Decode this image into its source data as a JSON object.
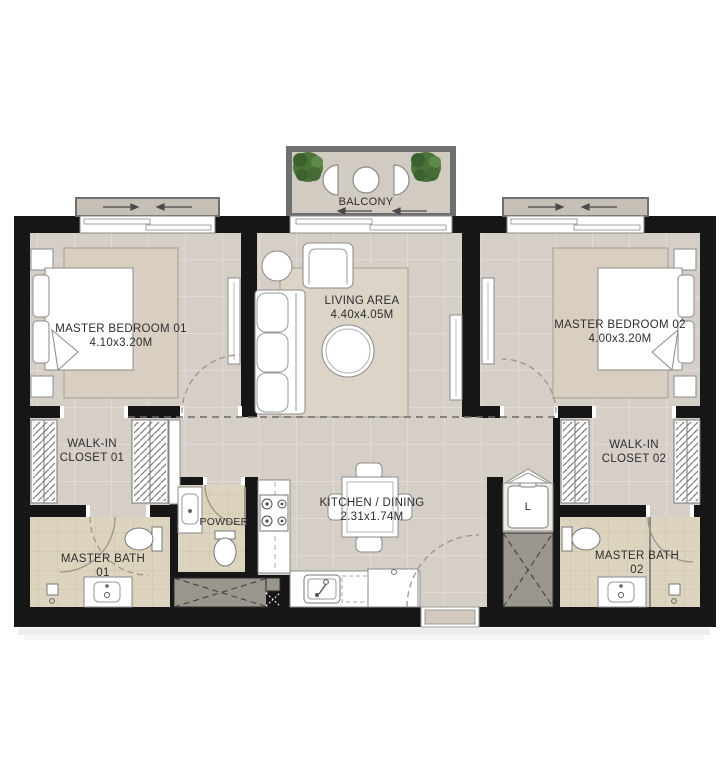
{
  "rooms": {
    "balcony": {
      "name": "BALCONY"
    },
    "master_bedroom_01": {
      "name": "MASTER BEDROOM 01",
      "dimensions": "4.10x3.20M"
    },
    "living_area": {
      "name": "LIVING AREA",
      "dimensions": "4.40x4.05M"
    },
    "master_bedroom_02": {
      "name": "MASTER BEDROOM 02",
      "dimensions": "4.00x3.20M"
    },
    "walk_in_closet_01": {
      "line1": "WALK-IN",
      "line2": "CLOSET 01"
    },
    "walk_in_closet_02": {
      "line1": "WALK-IN",
      "line2": "CLOSET 02"
    },
    "kitchen_dining": {
      "name": "KITCHEN / DINING",
      "dimensions": "2.31x1.74M"
    },
    "powder": {
      "name": "POWDER"
    },
    "master_bath_01": {
      "line1": "MASTER BATH",
      "line2": "01"
    },
    "master_bath_02": {
      "line1": "MASTER BATH",
      "line2": "02"
    },
    "laundry": {
      "name": "L"
    }
  },
  "colors": {
    "wall": "#161616",
    "floor": "#d6cfc7",
    "bedroom_rug": "#d9cfc1",
    "living_rug": "#dcd4c7",
    "bath_floor": "#ddd4c0",
    "balcony_floor": "#d2cbc1",
    "window_frame": "#c6bfb5",
    "shaft": "#9a968e",
    "furniture": "#ffffff",
    "plant": "#4c7339",
    "text": "#2d2d2d"
  }
}
